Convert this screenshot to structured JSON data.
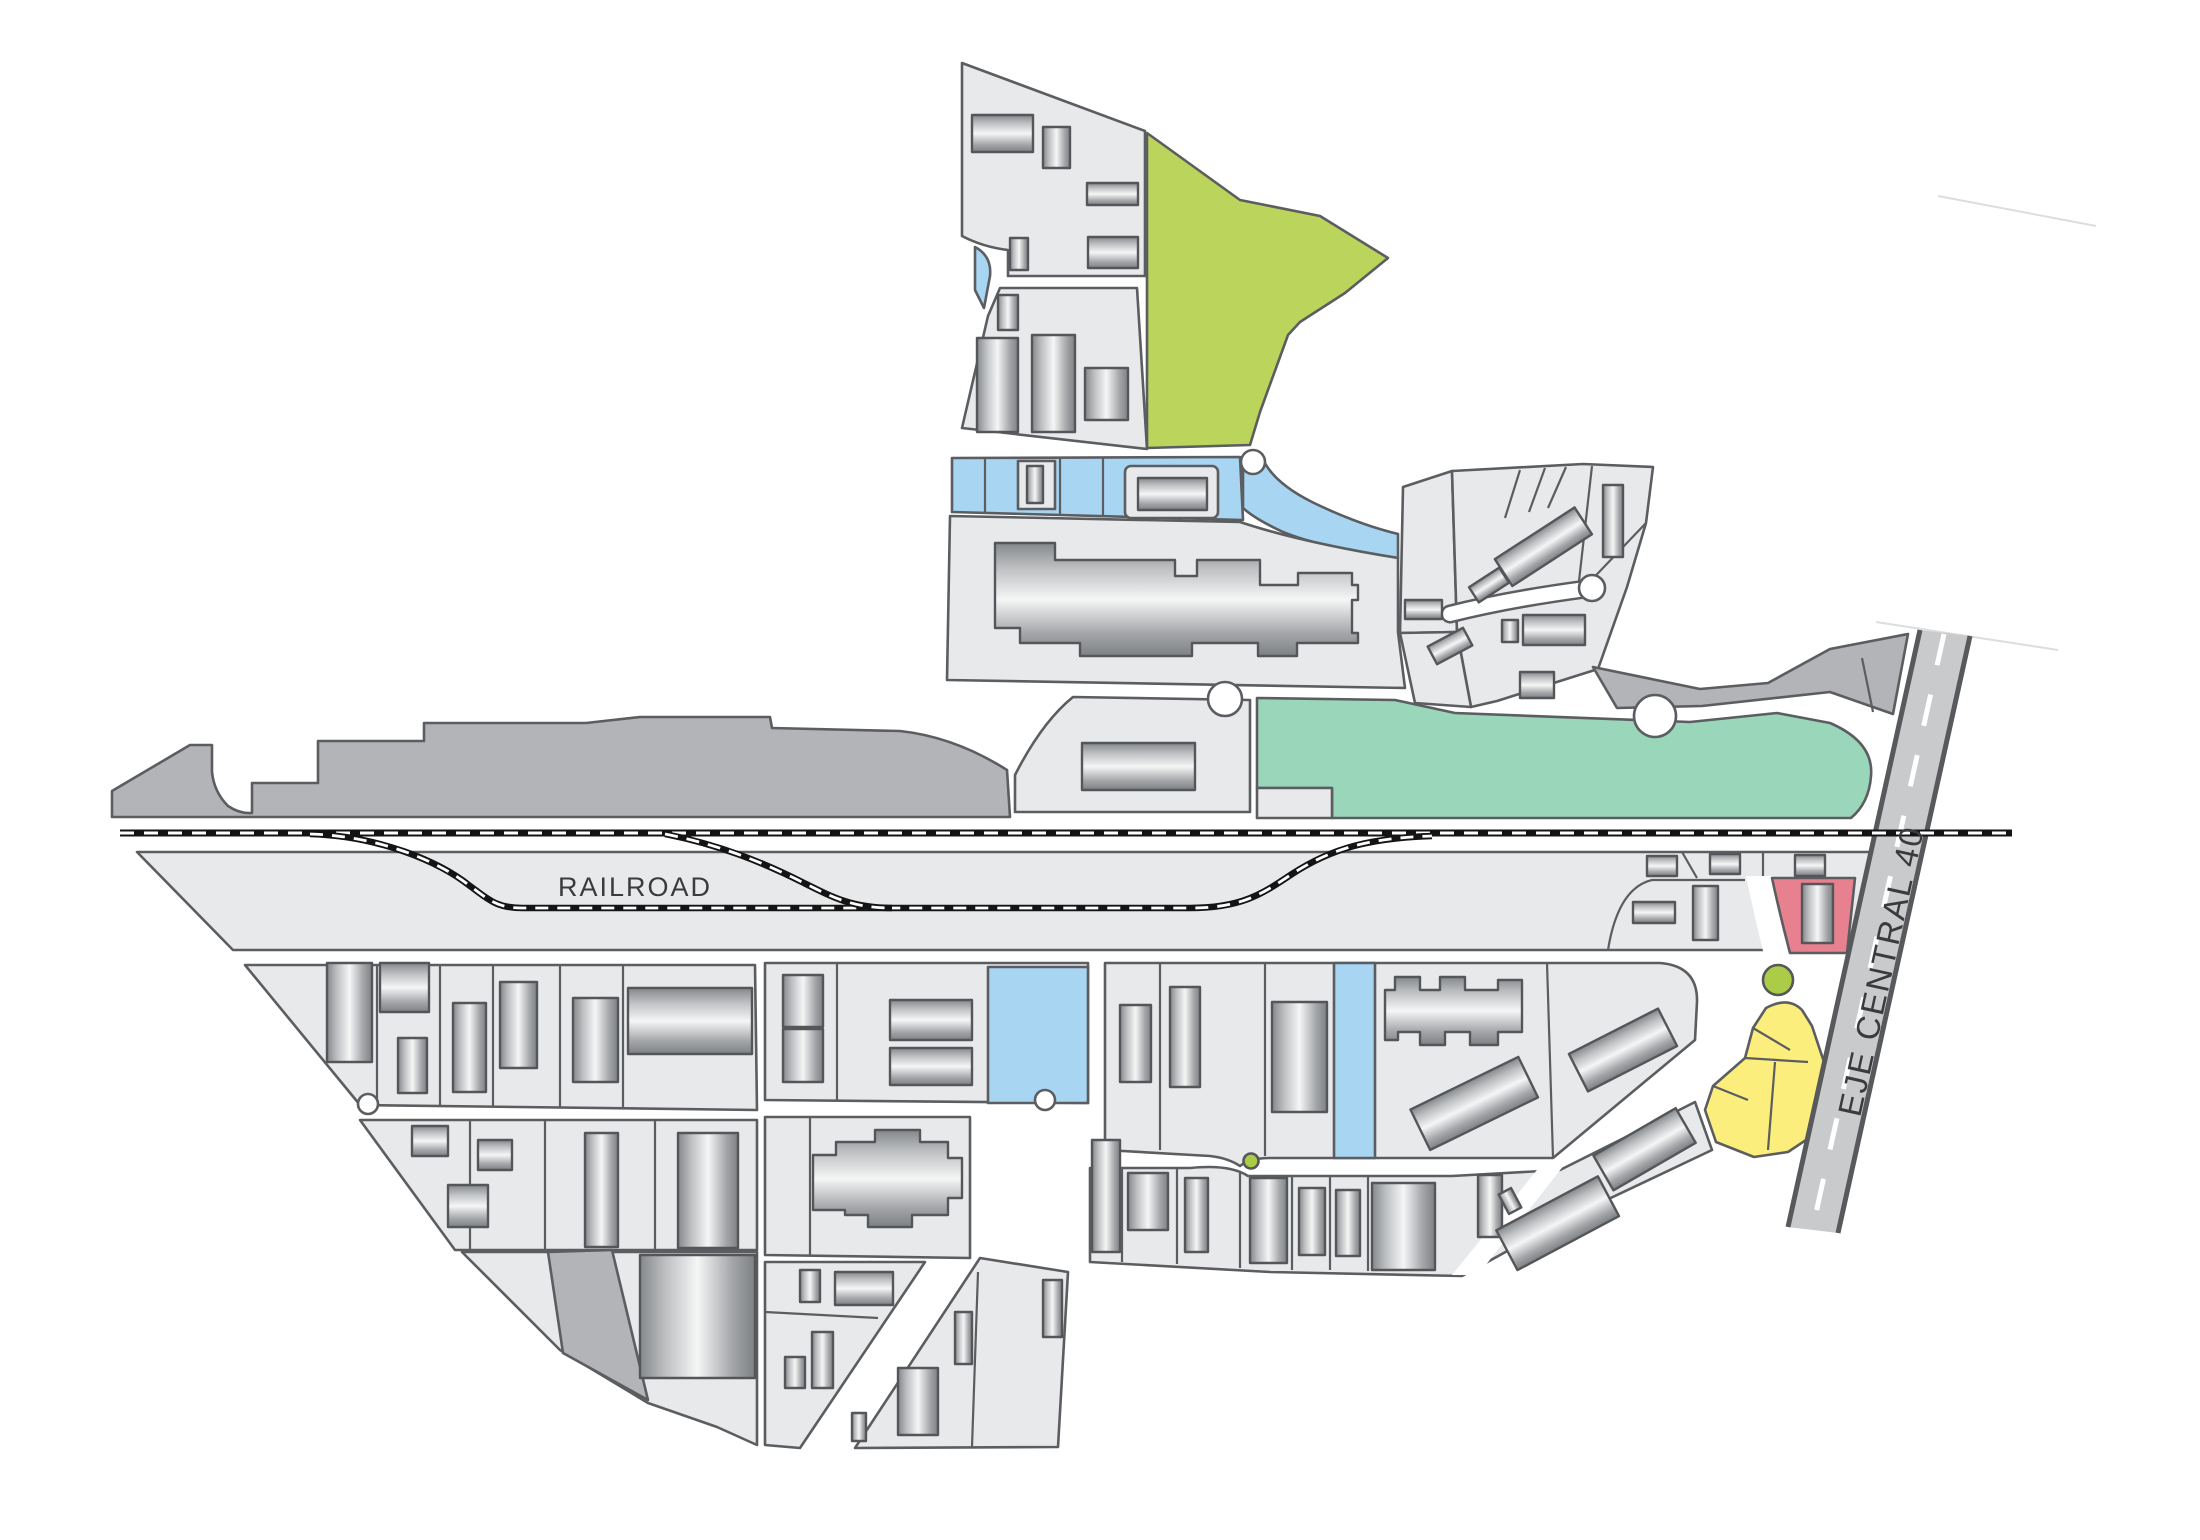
{
  "map": {
    "title": "Industrial district site plan",
    "labels": {
      "railroad": "RAILROAD",
      "main_road": "EJE CENTRAL 40"
    },
    "zones": [
      {
        "name": "standard-parcel",
        "color": "#e8e9ea"
      },
      {
        "name": "dark-gray-strip",
        "color": "#b2b4b7"
      },
      {
        "name": "teal-zone",
        "color": "#99d6ba"
      },
      {
        "name": "lime-green-zone",
        "color": "#bad45c"
      },
      {
        "name": "light-blue-zone",
        "color": "#a8d5f2"
      },
      {
        "name": "yellow-zone",
        "color": "#fbee7d"
      },
      {
        "name": "red-parcel",
        "color": "#e8818f"
      },
      {
        "name": "green-dot",
        "color": "#abcc47"
      },
      {
        "name": "road-surface",
        "color": "#c9cacb"
      },
      {
        "name": "outline",
        "color": "#5b5d60"
      }
    ]
  }
}
